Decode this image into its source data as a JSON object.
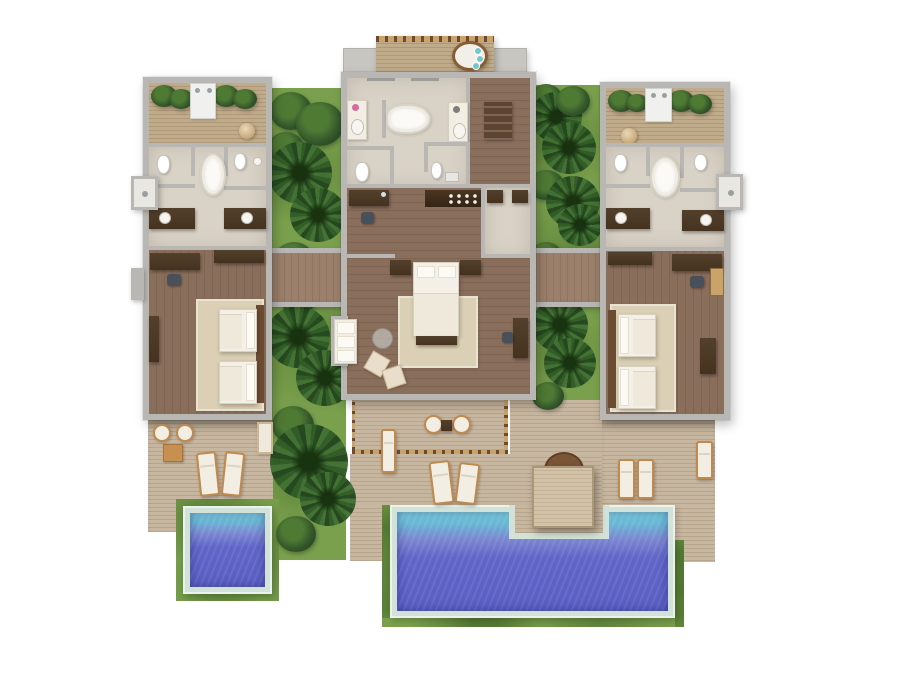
{
  "scene": {
    "type": "top-down-3d-floor-plan-render",
    "subject": "two-bedroom pool villa",
    "buildings": [
      {
        "id": "west-wing",
        "zones": [
          "outdoor-shower-garden",
          "bathroom",
          "twin-bedroom",
          "private-deck",
          "plunge-pool"
        ]
      },
      {
        "id": "master-pavilion",
        "zones": [
          "upper-balcony",
          "master-bathroom",
          "entry-hall",
          "minibar",
          "dressing-area",
          "master-bedroom",
          "lounge-corner",
          "private-deck"
        ]
      },
      {
        "id": "east-wing",
        "zones": [
          "outdoor-shower-garden",
          "bathroom",
          "twin-bedroom",
          "pool-deck"
        ]
      }
    ],
    "outdoor": {
      "pools": [
        {
          "id": "main-pool",
          "shape": "rectangle-with-deck-notch"
        },
        {
          "id": "plunge-pool",
          "shape": "square"
        }
      ],
      "gardens": 2,
      "sun_loungers": 8,
      "deck_armchairs": 2,
      "deck_chairs": 2,
      "pool_daybed_pavilions": 1
    },
    "fixtures": {
      "bathtubs": 3,
      "toilets": 6,
      "vanity_sinks": 6,
      "outdoor_showers": 2,
      "twin_beds": 4,
      "king_beds": 1,
      "balcony_daybeds": 1
    }
  },
  "palette": {
    "wall": "#b9b7b3",
    "wall_light": "#d2d0cb",
    "roof": "#c8c6c1",
    "stone": "#d9d2c6",
    "wood": "#8a6e5c",
    "wood_dark": "#806453",
    "corridor": "#9b806c",
    "corridor_dark": "#8f7562",
    "deck": "#c8b7a0",
    "deck_line": "#b7a58c",
    "balcony": "#c0ab8a",
    "balcony_line": "#ae9877",
    "grass": "#7aa04d",
    "grass_dark": "#4d7530",
    "pool_rim": "#d2e2d9",
    "pool_shallow": "#7ecfdd",
    "pool_deep": "#5a5fc2",
    "rug": "#dbd0b5",
    "furn_dark": "#46331f",
    "furn_wood": "#c08a4e",
    "furn_white": "#f2eee4",
    "railing": "#6b4c33",
    "cushion_teal": "#74c6cb"
  }
}
